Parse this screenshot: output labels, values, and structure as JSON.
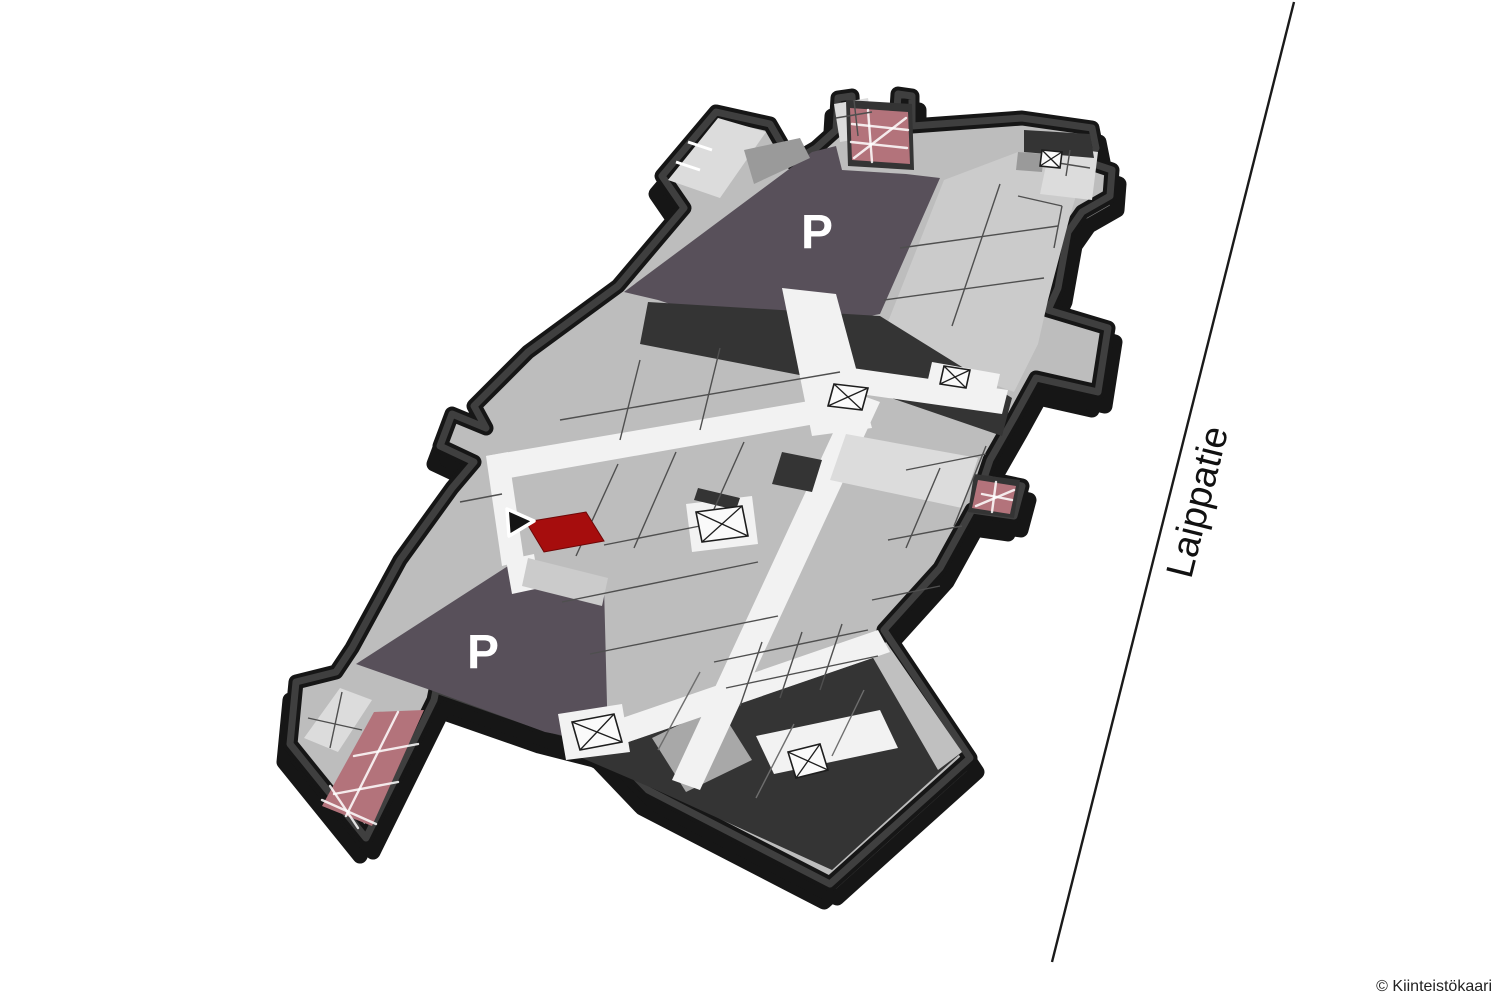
{
  "map": {
    "street": {
      "label": "Laippatie"
    },
    "copyright": "© Kiinteistökaari",
    "parking_north": {
      "label": "P"
    },
    "parking_south": {
      "label": "P"
    },
    "highlighted_room": {
      "status": "selected"
    },
    "marker": {
      "shape": "arrowhead"
    }
  },
  "colors": {
    "bg": "#ffffff",
    "highlight-red": "#a60d0d",
    "parking-purple": "#58505a",
    "ramp-pink": "#b3737b",
    "wall-dark": "#3f3f3f",
    "wall-outline": "#161616",
    "wall-side": "#7c7c7c",
    "floor-base": "#bdbdbd",
    "floor-light": "#cbcbcb",
    "room-bright": "#dcdcdc",
    "corridor-white": "#f2f2f2",
    "dark-room": "#343434",
    "divider": "#4f4f4f",
    "street-line": "#1a1a1a",
    "street-label": "#111111",
    "copyright-color": "#222222",
    "label-white": "#ffffff"
  }
}
